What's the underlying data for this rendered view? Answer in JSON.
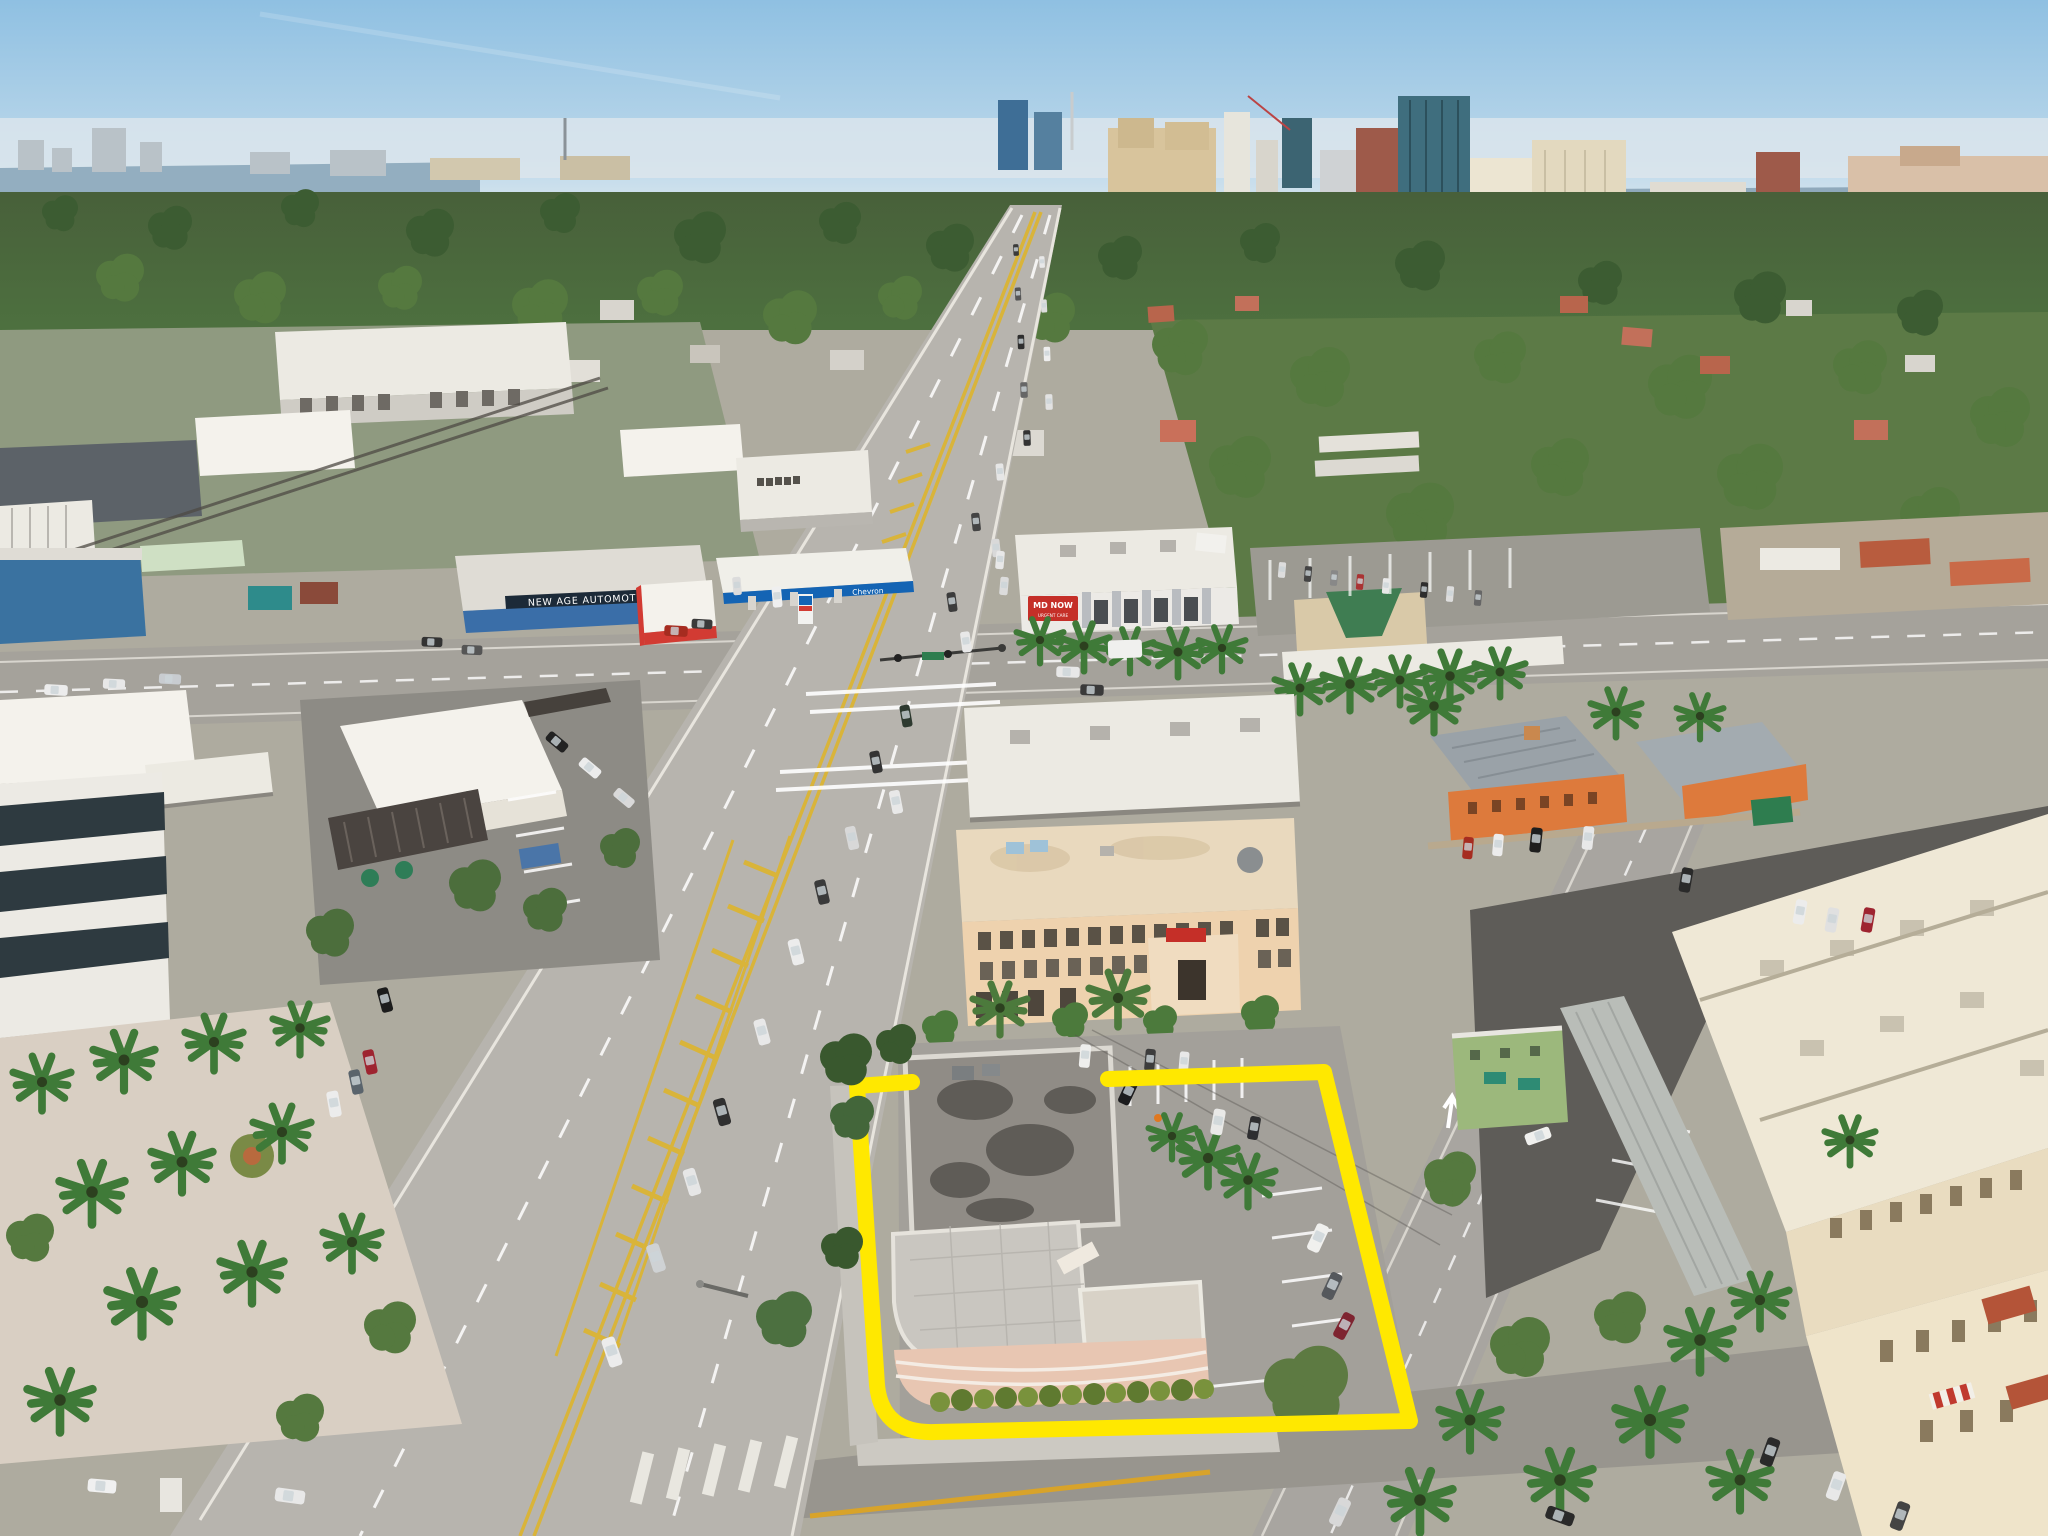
{
  "signs": {
    "new_age_automotive": "NEW AGE AUTOMOTIVE",
    "chevron": "Chevron",
    "md_now": "MD NOW",
    "md_now_sub": "URGENT CARE"
  },
  "colors": {
    "outline_yellow": "#ffe800",
    "chevron_blue": "#1464b4",
    "chevron_red": "#d23b33",
    "mdnow_red": "#c52f28",
    "starbucks_green": "#1f6b4a",
    "sky": "#9cc6e4",
    "water": "#8fa9bb",
    "subject_building_pink": "#e8c6b2"
  }
}
